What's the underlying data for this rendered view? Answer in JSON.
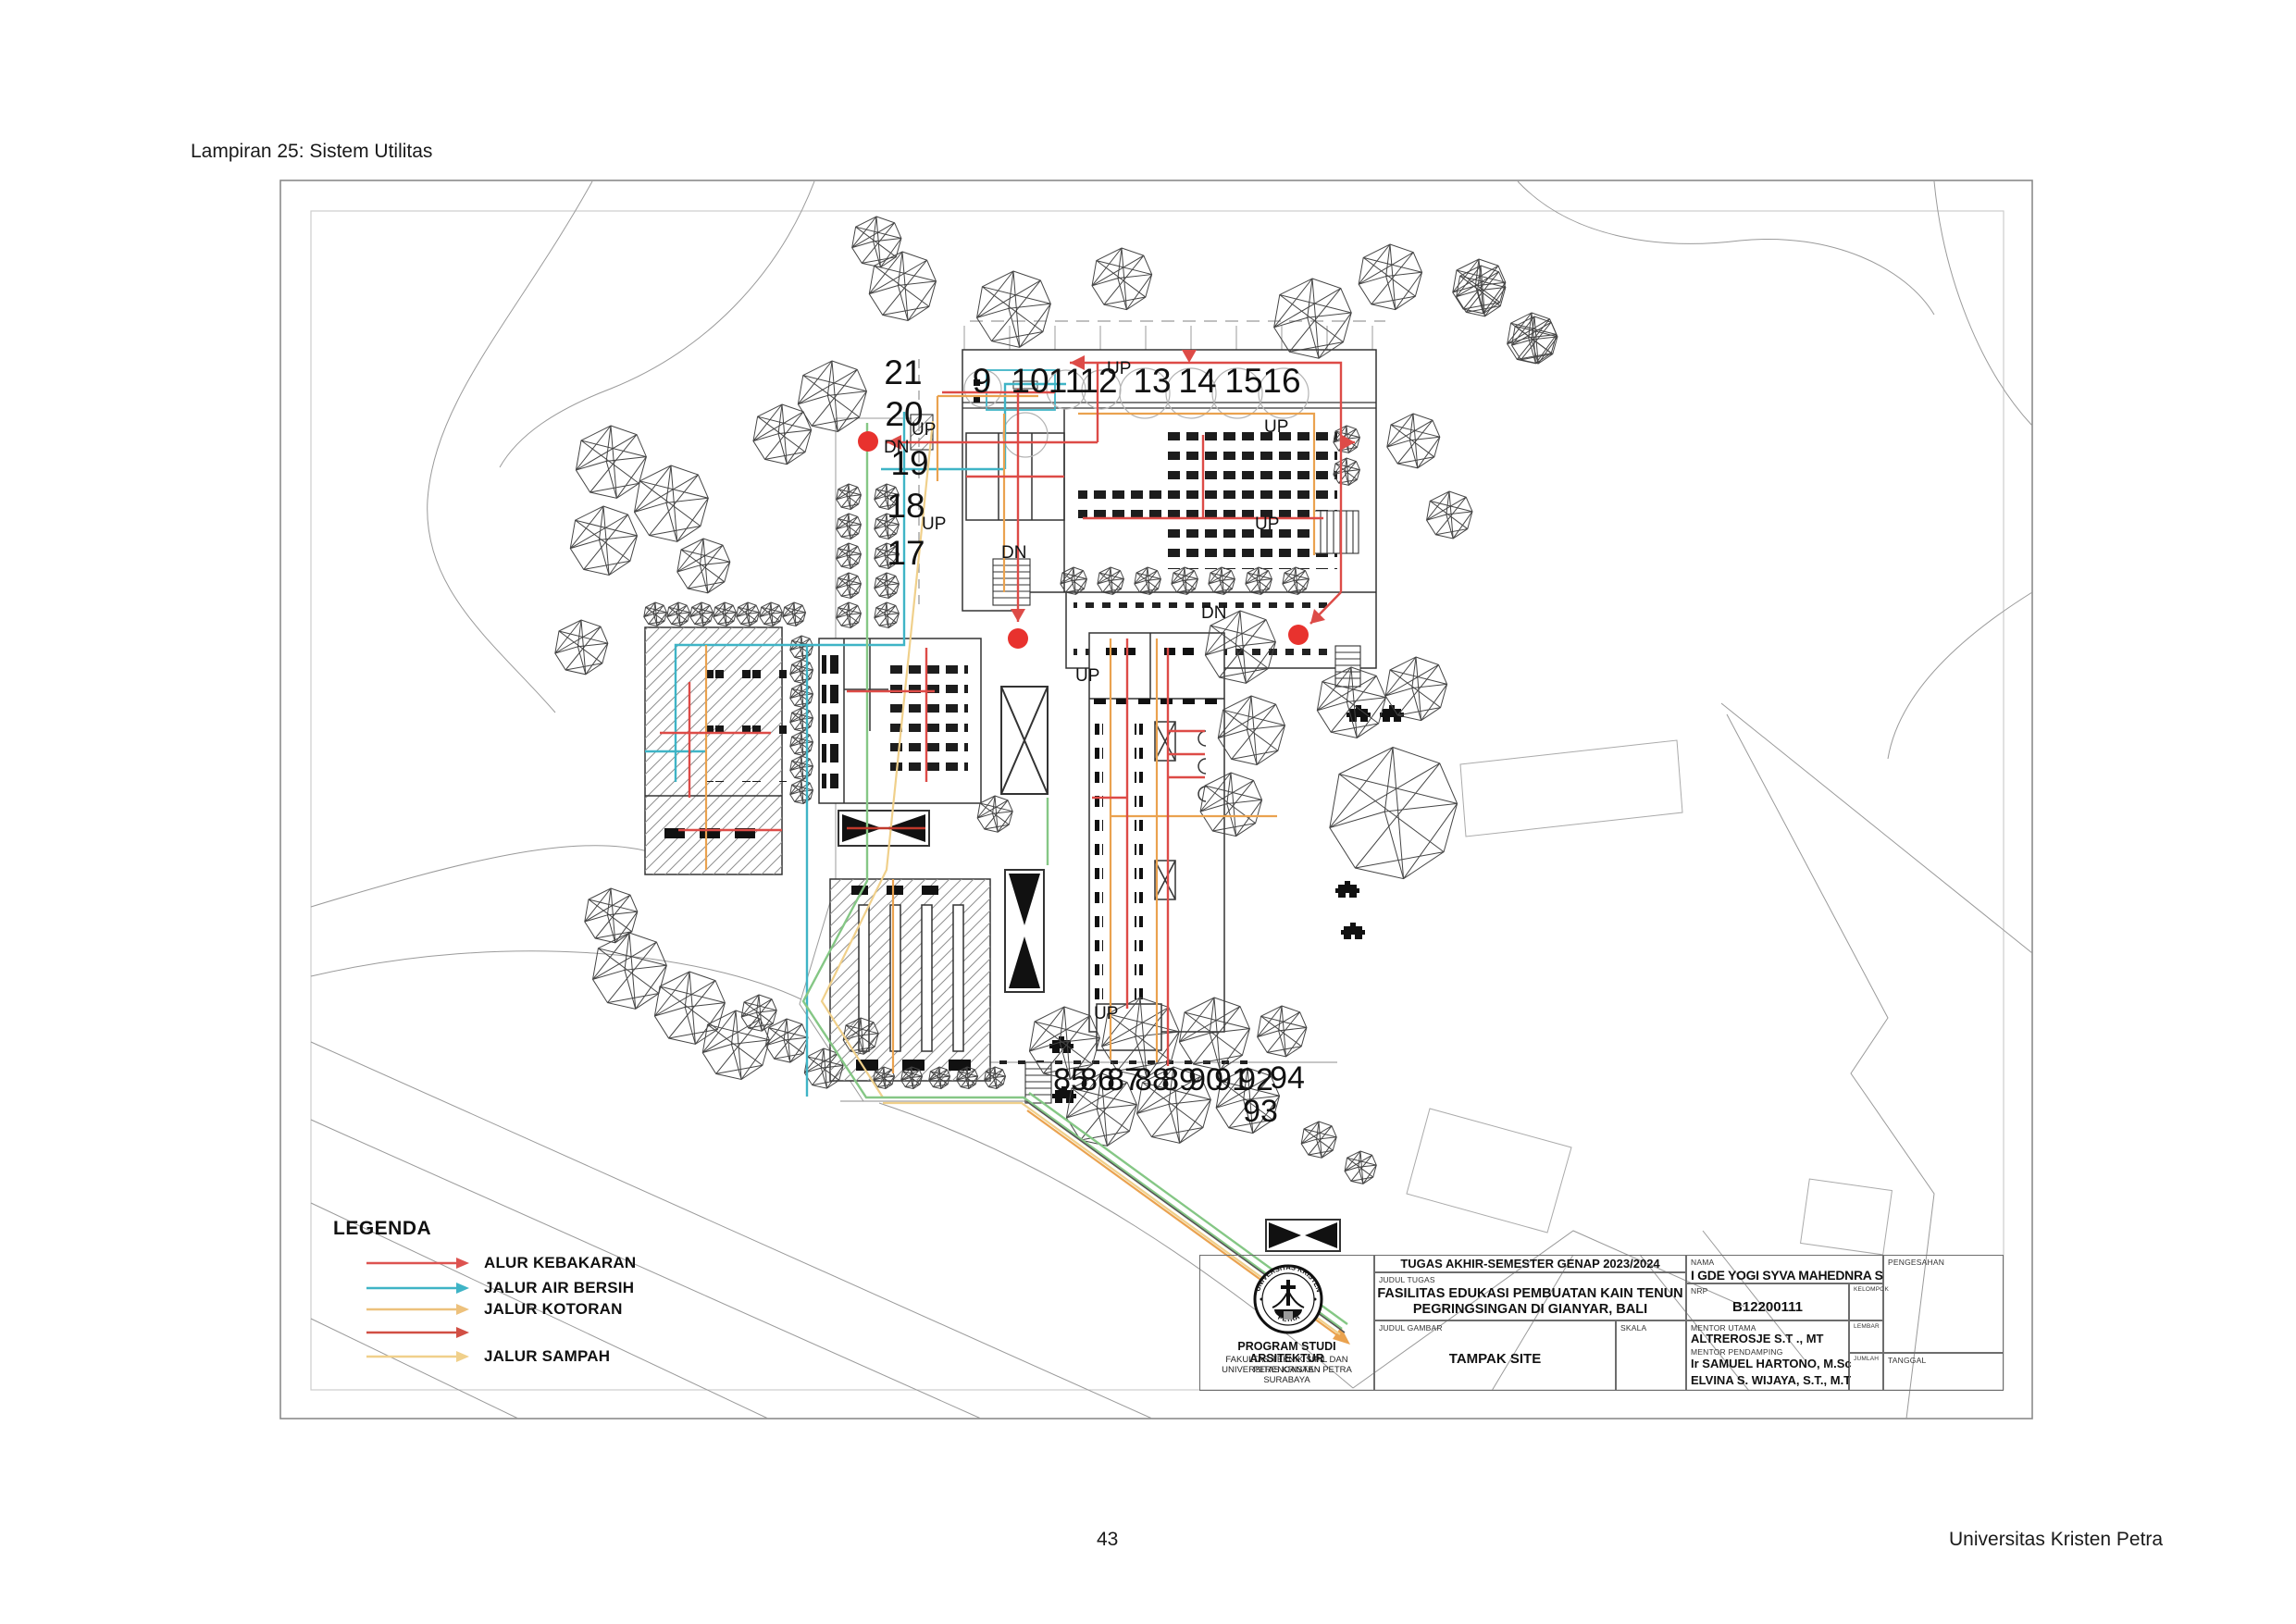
{
  "page": {
    "title": "Lampiran 25: Sistem Utilitas",
    "page_number": "43",
    "institution_footer": "Universitas Kristen Petra"
  },
  "legend": {
    "title": "LEGENDA",
    "items": [
      {
        "label": "ALUR KEBAKARAN",
        "color": "#dd5350"
      },
      {
        "label": "JALUR AIR BERSIH",
        "color": "#3fb4c6"
      },
      {
        "label": "JALUR KOTORAN",
        "color": "#edc17c"
      },
      {
        "label": "",
        "color": "#d14f44"
      },
      {
        "label": "JALUR SAMPAH",
        "color": "#f0d08b"
      }
    ]
  },
  "colors": {
    "fire": "#dd4b47",
    "clean_water": "#3fb4c6",
    "sewage": "#eaa24f",
    "waste": "#f0d08b",
    "green_path": "#85c785",
    "marker_red": "#e8322e"
  },
  "plan": {
    "up_label": "UP",
    "dn_label": "DN",
    "top_room_numbers": [
      "9",
      "10",
      "11",
      "12",
      "13",
      "14",
      "15",
      "16"
    ],
    "left_room_numbers": [
      "21",
      "20",
      "19",
      "18",
      "17"
    ],
    "bottom_tree_numbers": [
      "85",
      "86",
      "87",
      "88",
      "89",
      "90",
      "91",
      "92",
      "93",
      "94"
    ]
  },
  "title_block": {
    "project_header": "TUGAS AKHIR-SEMESTER GENAP 2023/2024",
    "judul_tugas_label": "JUDUL TUGAS",
    "judul_tugas_line1": "FASILITAS EDUKASI PEMBUATAN KAIN TENUN",
    "judul_tugas_line2": "PEGRINGSINGAN DI GIANYAR, BALI",
    "judul_gambar_label": "JUDUL GAMBAR",
    "judul_gambar_value": "TAMPAK SITE",
    "skala_label": "SKALA",
    "nama_label": "NAMA",
    "nama_value": "I GDE YOGI SYVA MAHEDNRA S",
    "nrp_label": "NRP",
    "nrp_value": "B12200111",
    "kelompok_label": "KELOMPOK",
    "mentor_utama_label": "MENTOR UTAMA",
    "mentor_utama_value": "ALTREROSJE S.T ., MT",
    "mentor_pendamping_label": "MENTOR PENDAMPING",
    "mentor_pendamping_value1": "Ir SAMUEL HARTONO, M.Sc",
    "mentor_pendamping_value2": "ELVINA S. WIJAYA, S.T., M.T",
    "lembar_label": "LEMBAR",
    "jumlah_label": "JUMLAH",
    "pengesahan_label": "PENGESAHAN",
    "tanggal_label": "TANGGAL",
    "institution": {
      "line1": "PROGRAM STUDI ARSITEKTUR",
      "line2": "FAKULTAS TEKNIK SIPIL DAN PERENCANAAN",
      "line3": "UNIVERSITAS KRISTEN PETRA",
      "line4": "SURABAYA"
    },
    "logo_ring_top": "UNIVERSITAS KRISTEN",
    "logo_ring_bottom": "PETRA"
  }
}
